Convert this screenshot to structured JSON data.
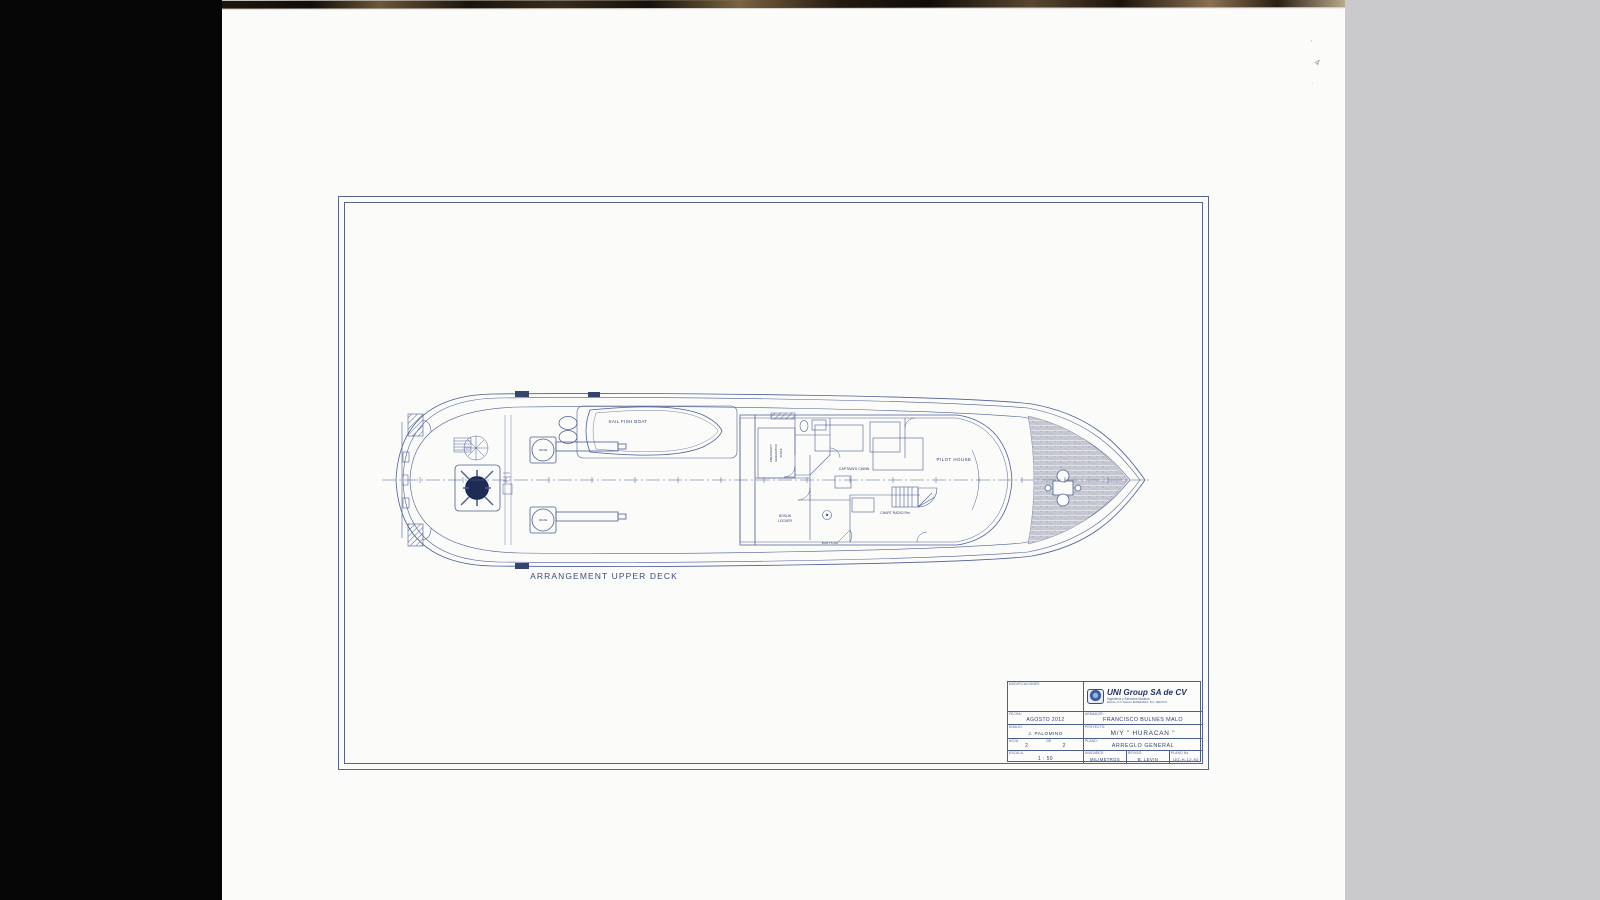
{
  "caption": "ARRANGEMENT UPPER DECK",
  "ship_labels": {
    "sail_fish_boat": "SAIL FISH BOAT",
    "crane": "CRANE",
    "emergency_l1": "EMERGENCY",
    "emergency_l2": "GENERATOR",
    "emergency_l3": "SPACE",
    "bosun_l1": "BOSUN",
    "bosun_l2": "LOCKER",
    "captains_cabin": "CAPTAIN'S CABIN",
    "chart_radio_rm": "CHART RADIO Rm",
    "buoys_rm": "BUOY'S Rm",
    "pilot_house": "PILOT HOUSE"
  },
  "title_block": {
    "revisions_label": "MODIFICACIONES",
    "company_name": "UNI Group SA de CV",
    "company_tagline": "Ingeniería y Servicios Marinos",
    "company_address": "México, D.F. México      ENSENADA, B.C. MEXICO",
    "fecha_label": "FECHA:",
    "fecha_value": "AGOSTO 2012",
    "armador_label": "ARMADOR:",
    "armador_value": "FRANCISCO BULNES MALO",
    "dibujo_label": "DIBUJO:",
    "dibujo_value": "J. PALOMINO",
    "proyecto_label": "PROYECTO:",
    "proyecto_value": "M/Y \" HURACAN \"",
    "hoja_label": "HOJA",
    "de_label": "DE",
    "hoja_value": "2",
    "de_value": "2",
    "plano_label": "PLANO:",
    "plano_value": "ARREGLO GENERAL",
    "escala_label": "ESCALA:",
    "escala_value": "1 : 50",
    "unidades_label": "UNIDADES:",
    "unidades_value": "MILIMETROS",
    "reviso_label": "REVISO:",
    "reviso_value": "B. LEVIN",
    "plano_no_label": "PLANO No.",
    "plano_no_value": "UG-H-12-92"
  },
  "margin_marks": {
    "m1": "’",
    "m2": "4",
    "m3": "·"
  },
  "colors": {
    "ink": "#4d5e96",
    "ink_dark": "#2e3e74",
    "paper": "#fbfbfa",
    "left_band": "#050505",
    "right_band": "#cacacd"
  }
}
